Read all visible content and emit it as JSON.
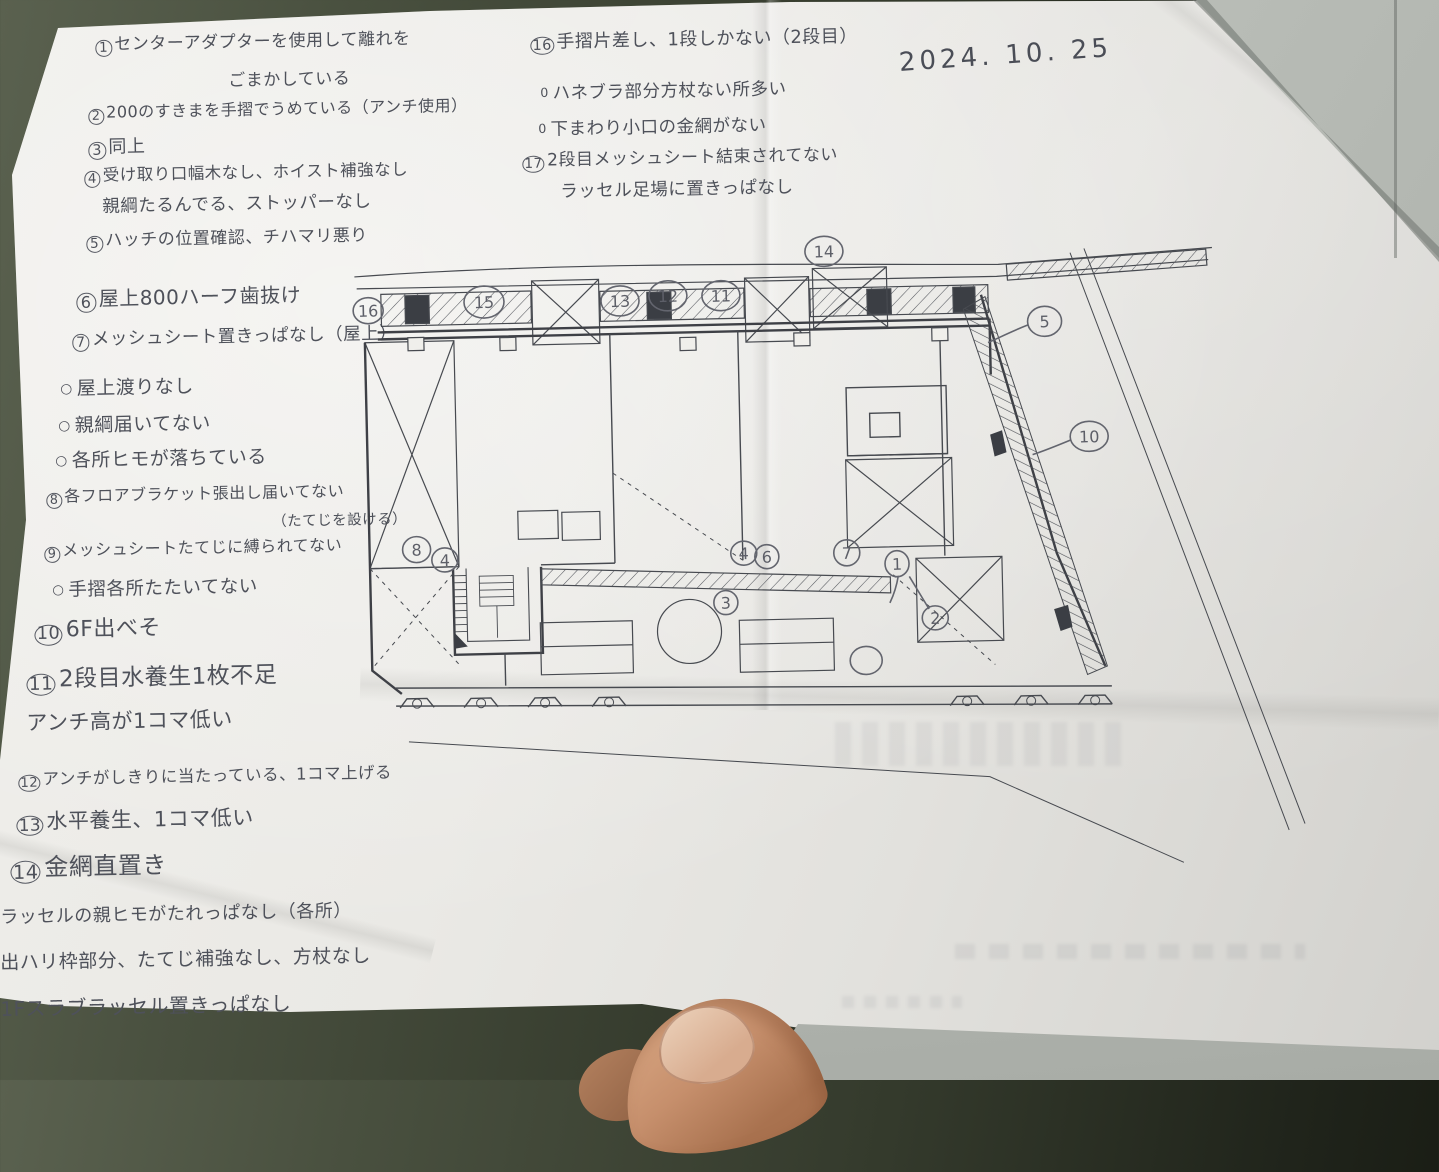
{
  "date_label": "2024. 10. 25",
  "colors": {
    "pencil": "#4e515a",
    "print_line": "#474a50",
    "paper": "#e9e8e4",
    "desk": "#343a2c"
  },
  "notes_left": [
    {
      "num": "1",
      "text": "センターアダプターを使用して離れを"
    },
    {
      "text": "ごまかしている"
    },
    {
      "num": "2",
      "text": "200のすきまを手摺でうめている（アンチ使用）"
    },
    {
      "num": "3",
      "text": "同上"
    },
    {
      "num": "4",
      "text": "受け取り口幅木なし、ホイスト補強なし"
    },
    {
      "text": "親綱たるんでる、ストッパーなし"
    },
    {
      "num": "5",
      "text": "ハッチの位置確認、チハマリ悪り"
    },
    {
      "num": "6",
      "text": "屋上800ハーフ歯抜け"
    },
    {
      "num": "7",
      "text": "メッシュシート置きっぱなし（屋上）"
    },
    {
      "marker": "○",
      "text": "屋上渡りなし"
    },
    {
      "marker": "○",
      "text": "親綱届いてない"
    },
    {
      "marker": "○",
      "text": "各所ヒモが落ちている"
    },
    {
      "num": "8",
      "text": "各フロアブラケット張出し届いてない"
    },
    {
      "text": "（たてじを設ける）"
    },
    {
      "num": "9",
      "text": "メッシュシートたてじに縛られてない"
    },
    {
      "marker": "○",
      "text": "手摺各所たたいてない"
    },
    {
      "num": "10",
      "text": "6F出べそ"
    },
    {
      "num": "11",
      "text": "2段目水養生1枚不足"
    },
    {
      "text": "アンチ高が1コマ低い"
    },
    {
      "num": "12",
      "text": "アンチがしきりに当たっている、1コマ上げる"
    },
    {
      "num": "13",
      "text": "水平養生、1コマ低い"
    },
    {
      "num": "14",
      "text": "金網直置き"
    },
    {
      "text": "ラッセルの親ヒモがたれっぱなし（各所）"
    },
    {
      "text": "出ハリ枠部分、たてじ補強なし、方杖なし"
    },
    {
      "text": "1Fスラブラッセル置きっぱなし"
    }
  ],
  "notes_right": [
    {
      "num": "16",
      "text": "手摺片差し、1段しかない（2段目）"
    },
    {
      "marker": "0",
      "text": "ハネブラ部分方杖ない所多い"
    },
    {
      "marker": "0",
      "text": "下まわり小口の金網がない"
    },
    {
      "num": "17",
      "text": "2段目メッシュシート結束されてない"
    },
    {
      "text": "ラッセル足場に置きっぱなし"
    }
  ],
  "plan": {
    "annotations": [
      {
        "label": "16"
      },
      {
        "label": "15"
      },
      {
        "label": "13"
      },
      {
        "label": "12"
      },
      {
        "label": "11"
      },
      {
        "label": "14"
      },
      {
        "label": "5"
      },
      {
        "label": "10"
      },
      {
        "label": "8"
      },
      {
        "label": "4"
      },
      {
        "label": "4"
      },
      {
        "label": "6"
      },
      {
        "label": "7"
      },
      {
        "label": "1"
      },
      {
        "label": "3"
      },
      {
        "label": "2"
      }
    ]
  }
}
